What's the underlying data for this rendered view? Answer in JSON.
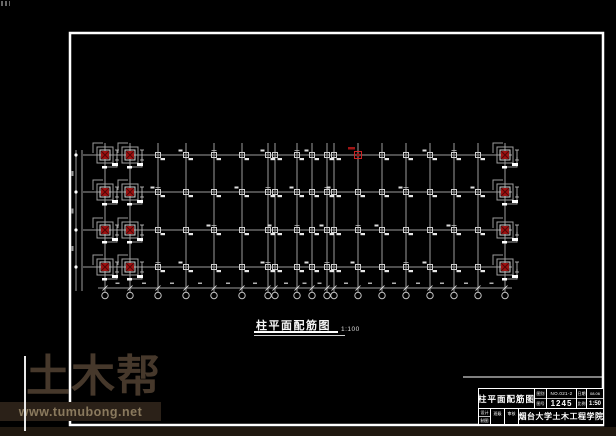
{
  "watermark": {
    "logo_text": "土木帮",
    "url": "www.tumubong.net",
    "colors": {
      "logo": "#46382b",
      "bar": "#2b2118",
      "url_text": "#8a7a5e",
      "strip": "#20180f",
      "divider": "#e8e8e8"
    }
  },
  "plan": {
    "title": "柱平面配筋图",
    "scale": "1:100",
    "x_axes": [
      105,
      130,
      158,
      186,
      214,
      242,
      268,
      275,
      297,
      312,
      327,
      334,
      358,
      382,
      406,
      430,
      454,
      478,
      505
    ],
    "row_ys": [
      155,
      192,
      230,
      267
    ],
    "geometry": {
      "axis_top_y": 143,
      "axis_bottom_y": 290,
      "bubble_y": 295.5,
      "bubble_r": 3.2,
      "bottom_dim_y": 288,
      "left_dim_x": 76,
      "left_dim_x2": 82,
      "row_x1": 83,
      "row_x2": 512
    },
    "red_left_axes": [
      0,
      1
    ],
    "red_right_axis": 18,
    "red_top_axis": 12,
    "colors": {
      "grid": "#9c9c9c",
      "column": "#cfcfcf",
      "label": "#e8e8e8",
      "red": "#9e1111",
      "red_dark": "#4f0808",
      "red_outline": "#cc2222",
      "frame": "#ffffff"
    }
  },
  "title_block": {
    "drawing_name": "柱平面配筋图",
    "row1": {
      "label_top": "图别",
      "label_bottom": "图号",
      "value_top": "NO.021-2",
      "value_bottom": "1245",
      "label2_top": "日期",
      "label2_bottom": "比例",
      "value2_top": "08.06",
      "value2_bottom": "1:50"
    },
    "row2": {
      "label_top": "设计",
      "label_bottom": "制图",
      "cell2": "班级",
      "cell3": "审核",
      "organization": "烟台大学土木工程学院"
    }
  }
}
